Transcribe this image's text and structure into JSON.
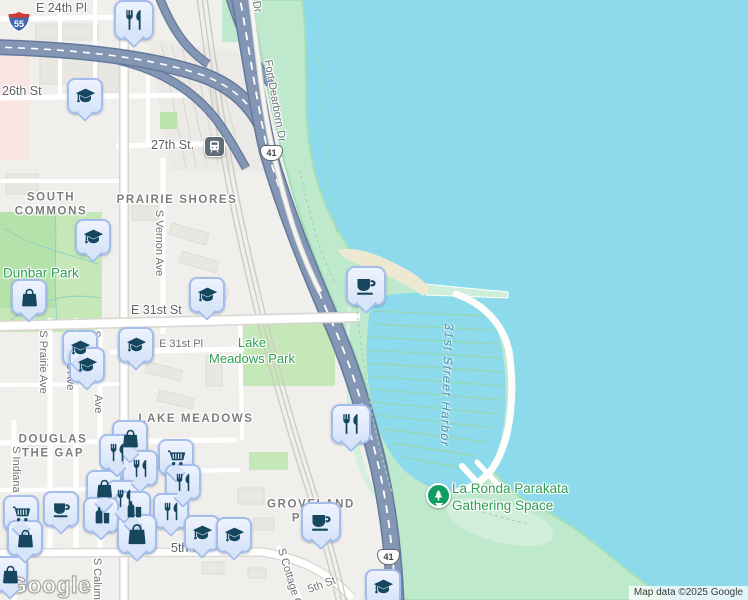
{
  "map": {
    "watermark": "Google",
    "attribution": "Map data ©2025 Google",
    "transit": {
      "label": "27th St.",
      "icon": "train-icon"
    },
    "shields": [
      {
        "route": "Interstate",
        "label": "55"
      },
      {
        "route": "US Highway",
        "label": "41"
      },
      {
        "route": "US Highway",
        "label": "41"
      }
    ],
    "colors": {
      "water": "#8ddaec",
      "lakefront_green": "#bfe9cc",
      "inland_park_green": "#c6e8b8",
      "sand": "#efe8d1",
      "highway": "#8397b5",
      "highway_casing": "#64789b",
      "pin_fill": "#dce9fb",
      "pin_border": "#a3bdec",
      "pin_glyph": "#16475f",
      "park_poi_green": "#0f9d63",
      "park_label_green": "#2f9e53",
      "water_label": "#4f95ab",
      "street_label": "#6d7277",
      "neighborhood_label": "#7d7d7d"
    },
    "labels": [
      {
        "t": "E 24th Pl",
        "x": 36,
        "y": 9,
        "cls": "l-st l-stlg",
        "name": "street-label-e-24th-pl"
      },
      {
        "t": "26th St",
        "x": 2,
        "y": 92,
        "cls": "l-st l-stlg",
        "name": "street-label-26th-st"
      },
      {
        "t": "E 31st St",
        "x": 131,
        "y": 311,
        "cls": "l-st l-stlg",
        "name": "street-label-e-31st-st"
      },
      {
        "t": "E 31st Pl",
        "x": 159,
        "y": 345,
        "cls": "l-st",
        "name": "street-label-e-31st-pl"
      },
      {
        "t": "5th St",
        "x": 171,
        "y": 549,
        "cls": "l-st l-stlg",
        "name": "street-label-35th-st"
      },
      {
        "t": "Dr",
        "x": 256,
        "y": 7,
        "cls": "l-st",
        "rot": 78,
        "cx": 1,
        "name": "street-label-dr-fragment"
      },
      {
        "t": "Fort Dearborn Dr",
        "x": 274,
        "y": 101,
        "cls": "l-st",
        "rot": 80,
        "cx": 1,
        "name": "street-label-fort-dearborn-dr"
      },
      {
        "t": "S Vernon Ave",
        "x": 158,
        "y": 243,
        "cls": "l-st",
        "rot": 90,
        "cx": 1,
        "name": "street-label-s-vernon-ave"
      },
      {
        "t": "S Prairie Ave",
        "x": 42,
        "y": 362,
        "cls": "l-st",
        "rot": 90,
        "cx": 1,
        "name": "street-label-s-prairie-ave"
      },
      {
        "t": "S Giles Ave",
        "x": 69,
        "y": 362,
        "cls": "l-st",
        "rot": 90,
        "cx": 1,
        "name": "street-label-s-giles-ave"
      },
      {
        "t": "S",
        "x": 95,
        "y": 334,
        "cls": "l-st",
        "rot": 90,
        "cx": 1,
        "name": "street-label-fragment-s"
      },
      {
        "t": "Ave",
        "x": 97,
        "y": 404,
        "cls": "l-st",
        "rot": 90,
        "cx": 1,
        "name": "street-label-fragment-ave"
      },
      {
        "t": "S Indiana Ave",
        "x": 15,
        "y": 480,
        "cls": "l-st",
        "rot": 90,
        "cx": 1,
        "name": "street-label-s-indiana-ave"
      },
      {
        "t": "S Calumet Ave",
        "x": 96,
        "y": 594,
        "cls": "l-st",
        "rot": 90,
        "cx": 1,
        "name": "street-label-s-calumet-ave"
      },
      {
        "t": "S Cottage Grove",
        "x": 292,
        "y": 588,
        "cls": "l-st",
        "rot": 73,
        "cx": 1,
        "name": "street-label-s-cottage-grove"
      },
      {
        "t": "5th St",
        "x": 322,
        "y": 586,
        "cls": "l-st",
        "rot": -20,
        "cx": 1,
        "name": "street-label-35th-st-diagonal"
      },
      {
        "lines": [
          "SOUTH",
          "COMMONS"
        ],
        "x": 51,
        "y": 205,
        "cls": "l-hood",
        "cx": 1,
        "name": "neighborhood-label-south-commons"
      },
      {
        "t": "PRAIRIE SHORES",
        "x": 177,
        "y": 200,
        "cls": "l-hood",
        "cx": 1,
        "name": "neighborhood-label-prairie-shores"
      },
      {
        "t": "LAKE MEADOWS",
        "x": 196,
        "y": 419,
        "cls": "l-hood",
        "cx": 1,
        "name": "neighborhood-label-lake-meadows"
      },
      {
        "lines": [
          "DOUGLAS",
          "THE GAP"
        ],
        "x": 53,
        "y": 447,
        "cls": "l-hood",
        "cx": 1,
        "name": "neighborhood-label-douglas-the-gap"
      },
      {
        "lines": [
          "GROVELAND",
          "PARK"
        ],
        "x": 311,
        "y": 512,
        "cls": "l-hood",
        "cx": 1,
        "name": "neighborhood-label-groveland-park"
      },
      {
        "t": "Dunbar Park",
        "x": 3,
        "y": 274,
        "cls": "l-park l-parkL",
        "name": "park-label-dunbar-park"
      },
      {
        "lines": [
          "Lake",
          "Meadows Park"
        ],
        "x": 252,
        "y": 351,
        "cls": "l-park",
        "cx": 1,
        "name": "park-label-lake-meadows-park"
      },
      {
        "lines": [
          "La Ronda Parakata",
          "Gathering Space"
        ],
        "x": 452,
        "y": 498,
        "cls": "l-park l-parkL",
        "name": "park-label-la-ronda-parakata"
      },
      {
        "t": "31st Street Harbor",
        "x": 446,
        "y": 385,
        "cls": "l-water",
        "rot": 92,
        "cx": 1,
        "name": "water-label-31st-street-harbor"
      }
    ],
    "pins": [
      {
        "icon": "restaurant-icon",
        "x": 134,
        "y": 0,
        "large": true
      },
      {
        "icon": "school-icon",
        "x": 85,
        "y": 78
      },
      {
        "icon": "school-icon",
        "x": 93,
        "y": 219
      },
      {
        "icon": "shopping-bag-icon",
        "x": 29,
        "y": 279
      },
      {
        "icon": "school-icon",
        "x": 207,
        "y": 277
      },
      {
        "icon": "school-icon",
        "x": 136,
        "y": 327
      },
      {
        "icon": "school-icon",
        "x": 80,
        "y": 330
      },
      {
        "icon": "school-icon",
        "x": 87,
        "y": 347
      },
      {
        "icon": "cafe-icon",
        "x": 366,
        "y": 266,
        "large": true
      },
      {
        "icon": "restaurant-icon",
        "x": 351,
        "y": 404,
        "large": true
      },
      {
        "icon": "shopping-bag-icon",
        "x": 130,
        "y": 420
      },
      {
        "icon": "restaurant-icon",
        "x": 117,
        "y": 434
      },
      {
        "icon": "shopping-cart-icon",
        "x": 176,
        "y": 439
      },
      {
        "icon": "restaurant-icon",
        "x": 140,
        "y": 450
      },
      {
        "icon": "restaurant-icon",
        "x": 183,
        "y": 464
      },
      {
        "icon": "shopping-bag-icon",
        "x": 104,
        "y": 470
      },
      {
        "icon": "restaurant-icon",
        "x": 124,
        "y": 480
      },
      {
        "icon": "convenience-store-icon",
        "x": 133,
        "y": 491
      },
      {
        "icon": "cafe-icon",
        "x": 61,
        "y": 491
      },
      {
        "icon": "shopping-cart-icon",
        "x": 21,
        "y": 495
      },
      {
        "icon": "restaurant-icon",
        "x": 171,
        "y": 493
      },
      {
        "icon": "convenience-store-icon",
        "x": 101,
        "y": 497
      },
      {
        "icon": "cafe-icon",
        "x": 321,
        "y": 502,
        "large": true
      },
      {
        "icon": "school-icon",
        "x": 202,
        "y": 515
      },
      {
        "icon": "school-icon",
        "x": 234,
        "y": 517
      },
      {
        "icon": "shopping-bag-icon",
        "x": 137,
        "y": 514,
        "large": true
      },
      {
        "icon": "shopping-bag-icon",
        "x": 25,
        "y": 520
      },
      {
        "icon": "shopping-bag-icon",
        "x": 10,
        "y": 556
      },
      {
        "icon": "school-icon",
        "x": 383,
        "y": 569
      }
    ]
  }
}
